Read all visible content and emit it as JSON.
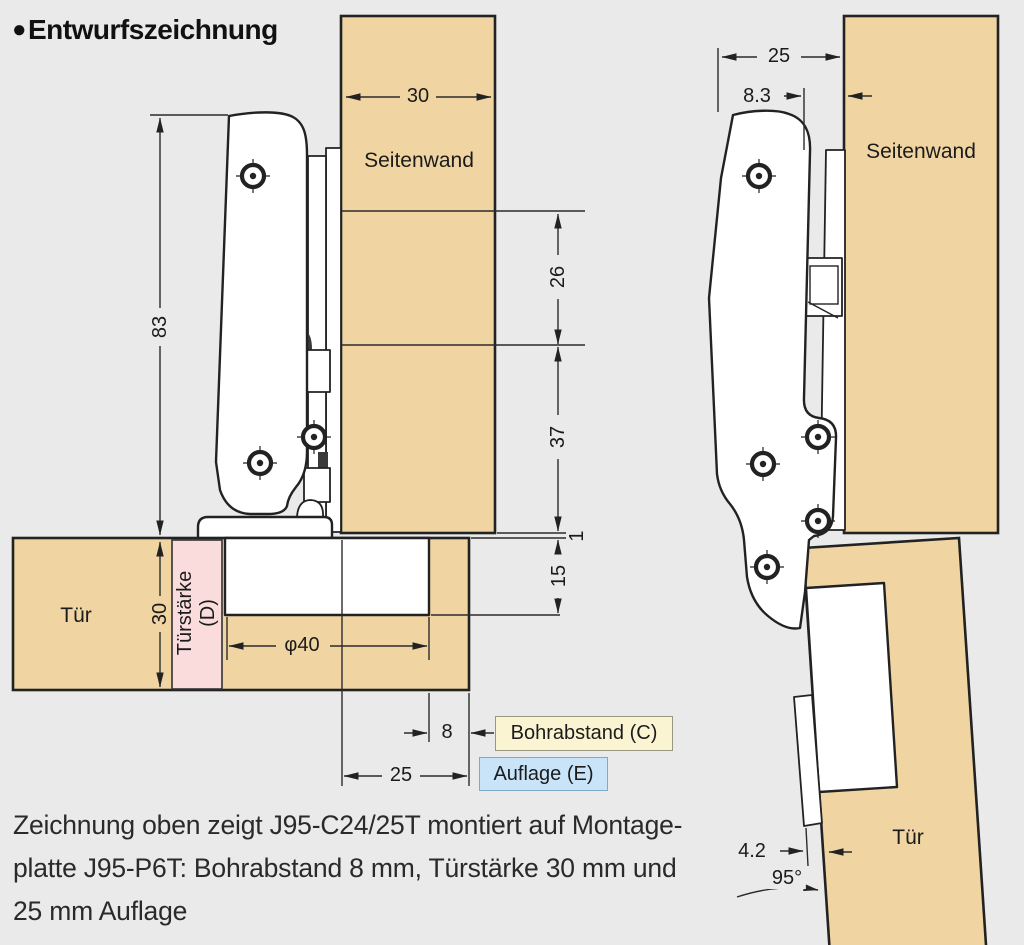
{
  "title": {
    "bullet": "●",
    "text": "Entwurfszeichnung"
  },
  "left_view": {
    "labels": {
      "side_panel": "Seitenwand",
      "door": "Tür",
      "door_thickness": "Türstärke",
      "door_thickness_code": "(D)"
    },
    "dims": {
      "panel_width": "30",
      "hinge_height": "83",
      "hole_offset_top": "26",
      "hole_span": "37",
      "gap": "1",
      "cup_depth": "15",
      "door_thickness": "30",
      "cup_diameter": "φ40",
      "drill_distance": "8",
      "overlay": "25"
    }
  },
  "right_view": {
    "labels": {
      "side_panel": "Seitenwand",
      "door": "Tür"
    },
    "dims": {
      "overlay": "25",
      "plate_offset": "8.3",
      "protrusion": "4.2",
      "opening_angle": "95°"
    }
  },
  "callouts": {
    "drill_distance": "Bohrabstand (C)",
    "overlay": "Auflage (E)"
  },
  "caption": "Zeichnung oben zeigt J95-C24/25T montiert auf Montage-\nplatte J95-P6T: Bohrabstand 8 mm, Türstärke 30 mm und\n25 mm Auflage",
  "colors": {
    "background": "#eaeaea",
    "wood": "#f0d5a2",
    "line": "#222222",
    "pink": "#fadcdc",
    "callout_yellow": "#faf4d2",
    "callout_blue": "#c9e4f8"
  }
}
